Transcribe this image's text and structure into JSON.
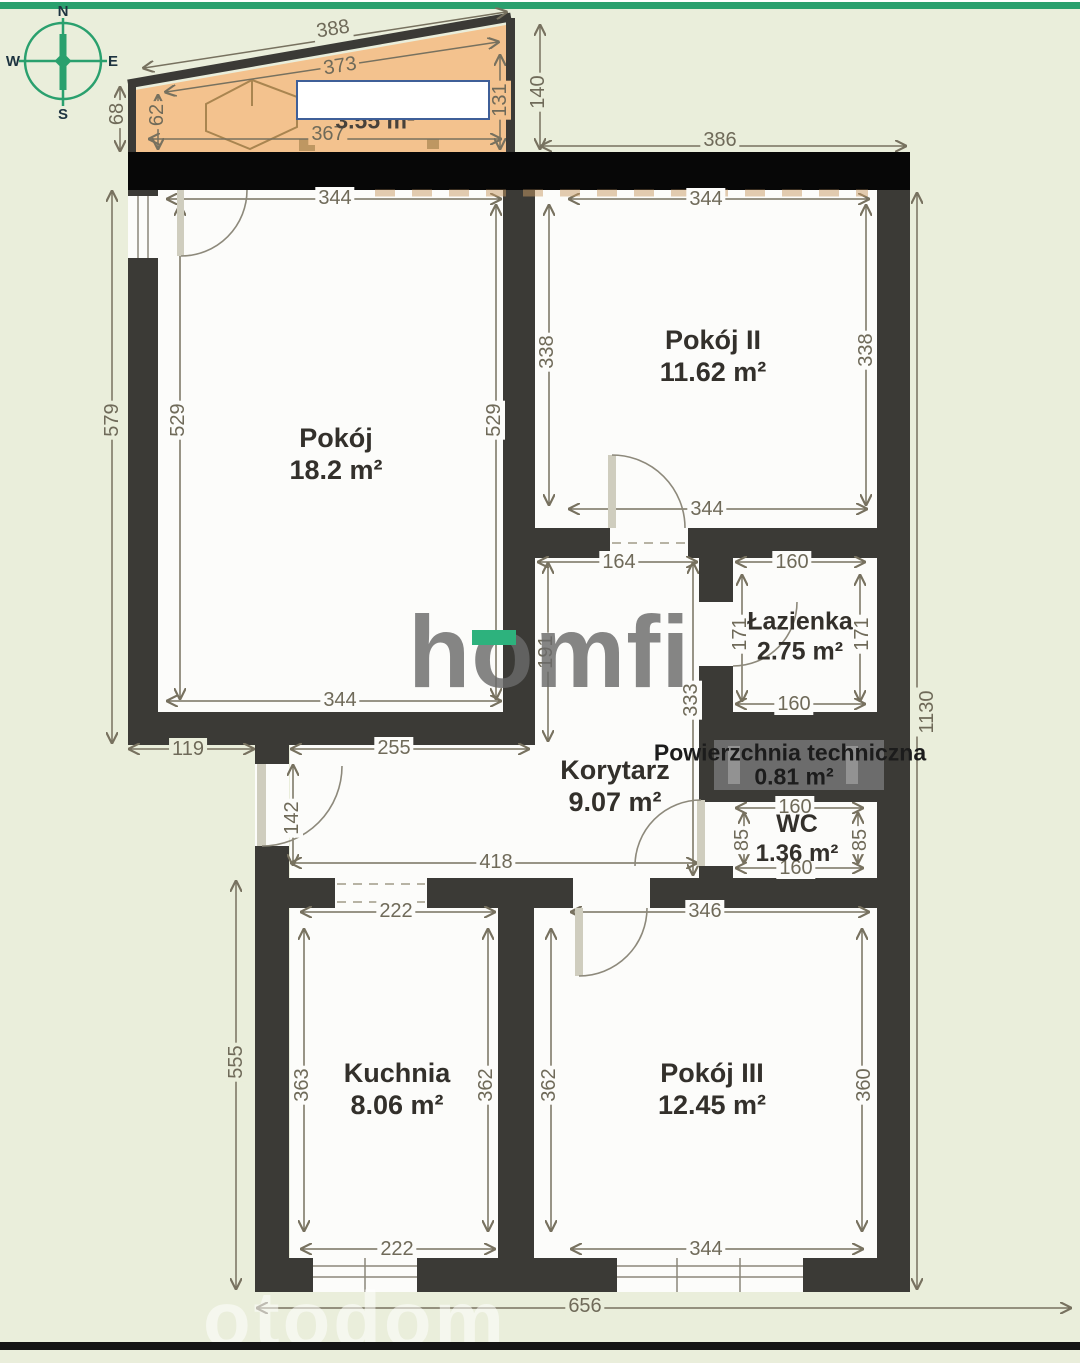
{
  "compass": {
    "north": "N",
    "east": "E",
    "south": "S",
    "west": "W"
  },
  "rooms": {
    "pokoj": {
      "name": "Pokój",
      "area": "18.2 m²"
    },
    "pokoj2": {
      "name": "Pokój II",
      "area": "11.62 m²"
    },
    "lazienka": {
      "name": "Łazienka",
      "area": "2.75 m²"
    },
    "korytarz": {
      "name": "Korytarz",
      "area": "9.07 m²"
    },
    "tech": {
      "name": "Powierzchnia techniczna",
      "area": "0.81 m²"
    },
    "wc": {
      "name": "WC",
      "area": "1.36 m²"
    },
    "kuchnia": {
      "name": "Kuchnia",
      "area": "8.06 m²"
    },
    "pokoj3": {
      "name": "Pokój III",
      "area": "12.45 m²"
    },
    "balkon": {
      "area": "3.55 m²"
    }
  },
  "dims": {
    "balcony": {
      "outer_top": "388",
      "inner_top": "373",
      "outer_left": "68",
      "inner_left": "62",
      "inner_right": "131",
      "outer_right": "140",
      "inner_bottom": "367"
    },
    "top_wall": {
      "right_span": "386"
    },
    "pokoj": {
      "top": "344",
      "left": "529",
      "right": "529",
      "bottom": "344",
      "outer_left": "579"
    },
    "pokoj2": {
      "top": "344",
      "left": "338",
      "right": "338",
      "bottom": "344"
    },
    "lazienka": {
      "top": "160",
      "left": "171",
      "right": "171",
      "bottom": "160"
    },
    "korytarz": {
      "upper_width": "164",
      "upper_height": "191",
      "full_height": "333",
      "top_width": "255",
      "outer_step": "119",
      "entry_door": "142",
      "bottom_width": "418"
    },
    "wc": {
      "top": "160",
      "left": "85",
      "right": "85",
      "bottom": "160"
    },
    "kuchnia": {
      "top": "222",
      "left": "363",
      "right": "362",
      "bottom": "222",
      "outer_left": "555"
    },
    "pokoj3": {
      "top": "346",
      "left": "362",
      "right": "360",
      "bottom": "344"
    },
    "outer": {
      "bottom": "656",
      "right": "1130"
    }
  },
  "watermarks": {
    "brand": "homfi",
    "portal": "otodom"
  },
  "colors": {
    "accent_green": "#2aa06e",
    "balcony_fill": "#f3c28e",
    "wall": "#3b3a36",
    "background": "#eaeedb"
  }
}
